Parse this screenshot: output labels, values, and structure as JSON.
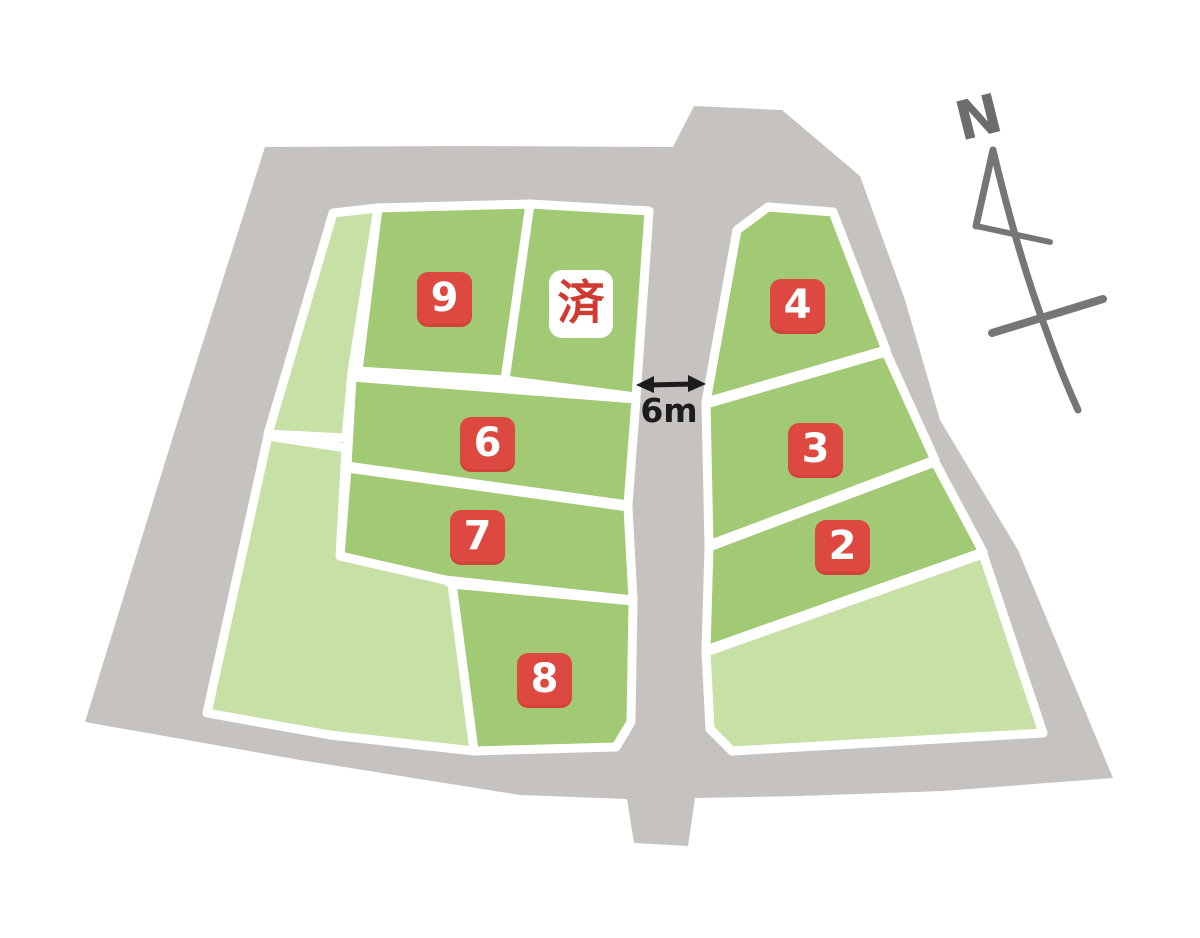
{
  "map": {
    "compass_label": "N",
    "road_width_label": "6m",
    "sold_label": "済",
    "colors": {
      "road": "#c6c2bf",
      "parcel_green": "#a2c973",
      "parcel_green_light": "#c6e0a6",
      "divider": "#ffffff",
      "badge_red": "#dd4941",
      "badge_number": "#ffffff",
      "sold_badge_bg": "#ffffff",
      "sold_badge_text": "#cf3b30",
      "arrow": "#1c1c1c",
      "compass": "#767676"
    }
  },
  "lots": [
    {
      "number": "9",
      "status": "available"
    },
    {
      "number": "済",
      "status": "sold"
    },
    {
      "number": "6",
      "status": "available"
    },
    {
      "number": "7",
      "status": "available"
    },
    {
      "number": "8",
      "status": "available"
    },
    {
      "number": "4",
      "status": "available"
    },
    {
      "number": "3",
      "status": "available"
    },
    {
      "number": "2",
      "status": "available"
    }
  ]
}
